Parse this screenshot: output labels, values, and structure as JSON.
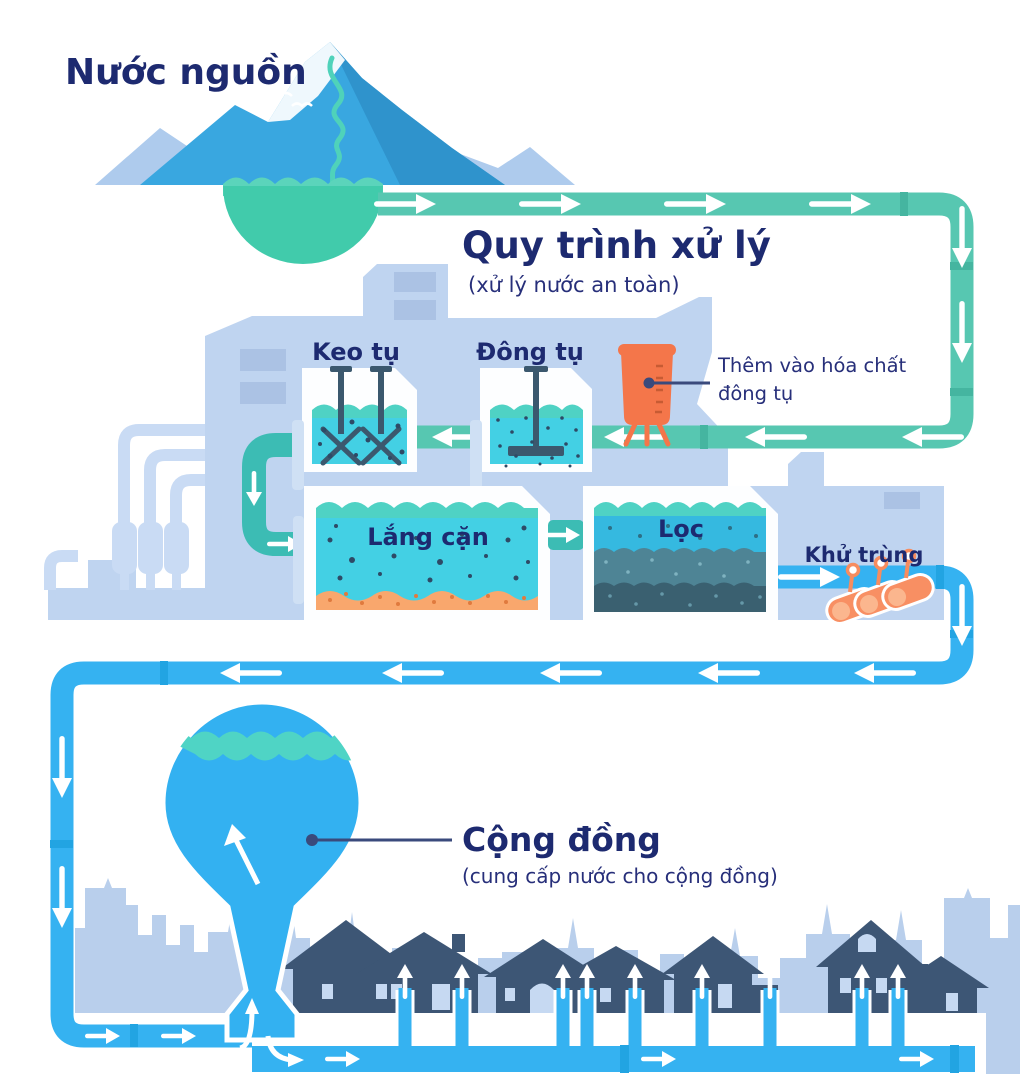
{
  "palette": {
    "navy_text": "#1d2a70",
    "teal_pipe": "#57c7b1",
    "dark_teal_pipe": "#3cbcb4",
    "blue_pipe": "#35b2f1",
    "plant_building": "#bfd4f0",
    "city_skyline": "#b9cfec",
    "house_silhouette": "#3d5675",
    "water_cyan": "#43d0e4",
    "wave_teal": "#4fd2c4",
    "sediment_orange": "#f9a76d",
    "chemical_orange": "#f4764a",
    "source_pool_teal": "#41cbab",
    "mountain_blue": "#39a7e0"
  },
  "source": {
    "title": "Nước nguồn"
  },
  "process": {
    "title": "Quy trình xử lý",
    "subtitle": "(xử lý nước an toàn)",
    "stages": [
      {
        "id": "coagulation",
        "label": "Keo tụ"
      },
      {
        "id": "flocculation",
        "label": "Đông tụ"
      },
      {
        "id": "sedimentation",
        "label": "Lắng cặn"
      },
      {
        "id": "filtration",
        "label": "Lọc"
      },
      {
        "id": "disinfection",
        "label": "Khử trùng"
      }
    ],
    "annotation": {
      "line1": "Thêm vào hóa chất",
      "line2": "đông tụ"
    }
  },
  "community": {
    "title": "Cộng đồng",
    "subtitle": "(cung cấp nước cho cộng đồng)"
  }
}
